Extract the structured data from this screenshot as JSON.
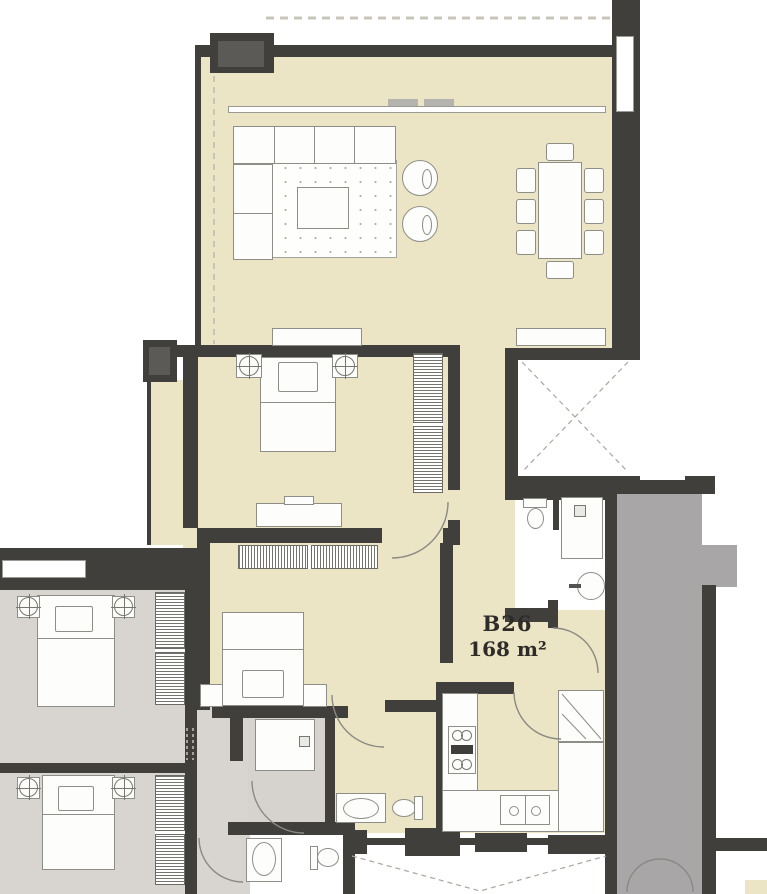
{
  "unit": {
    "label": "B26",
    "area": "168 m²"
  },
  "palette": {
    "wall": "#413f3c",
    "unit_floor": "#ebe4c5",
    "adjacent_unit_floor": "#d8d4d0",
    "corridor_floor": "#a8a6a6",
    "wet_room_floor": "#d6d3cf",
    "outline": "#8e8e89",
    "arc": "#8b8984",
    "dash": "#c8c4b8",
    "label_text": "#2e2c28"
  }
}
